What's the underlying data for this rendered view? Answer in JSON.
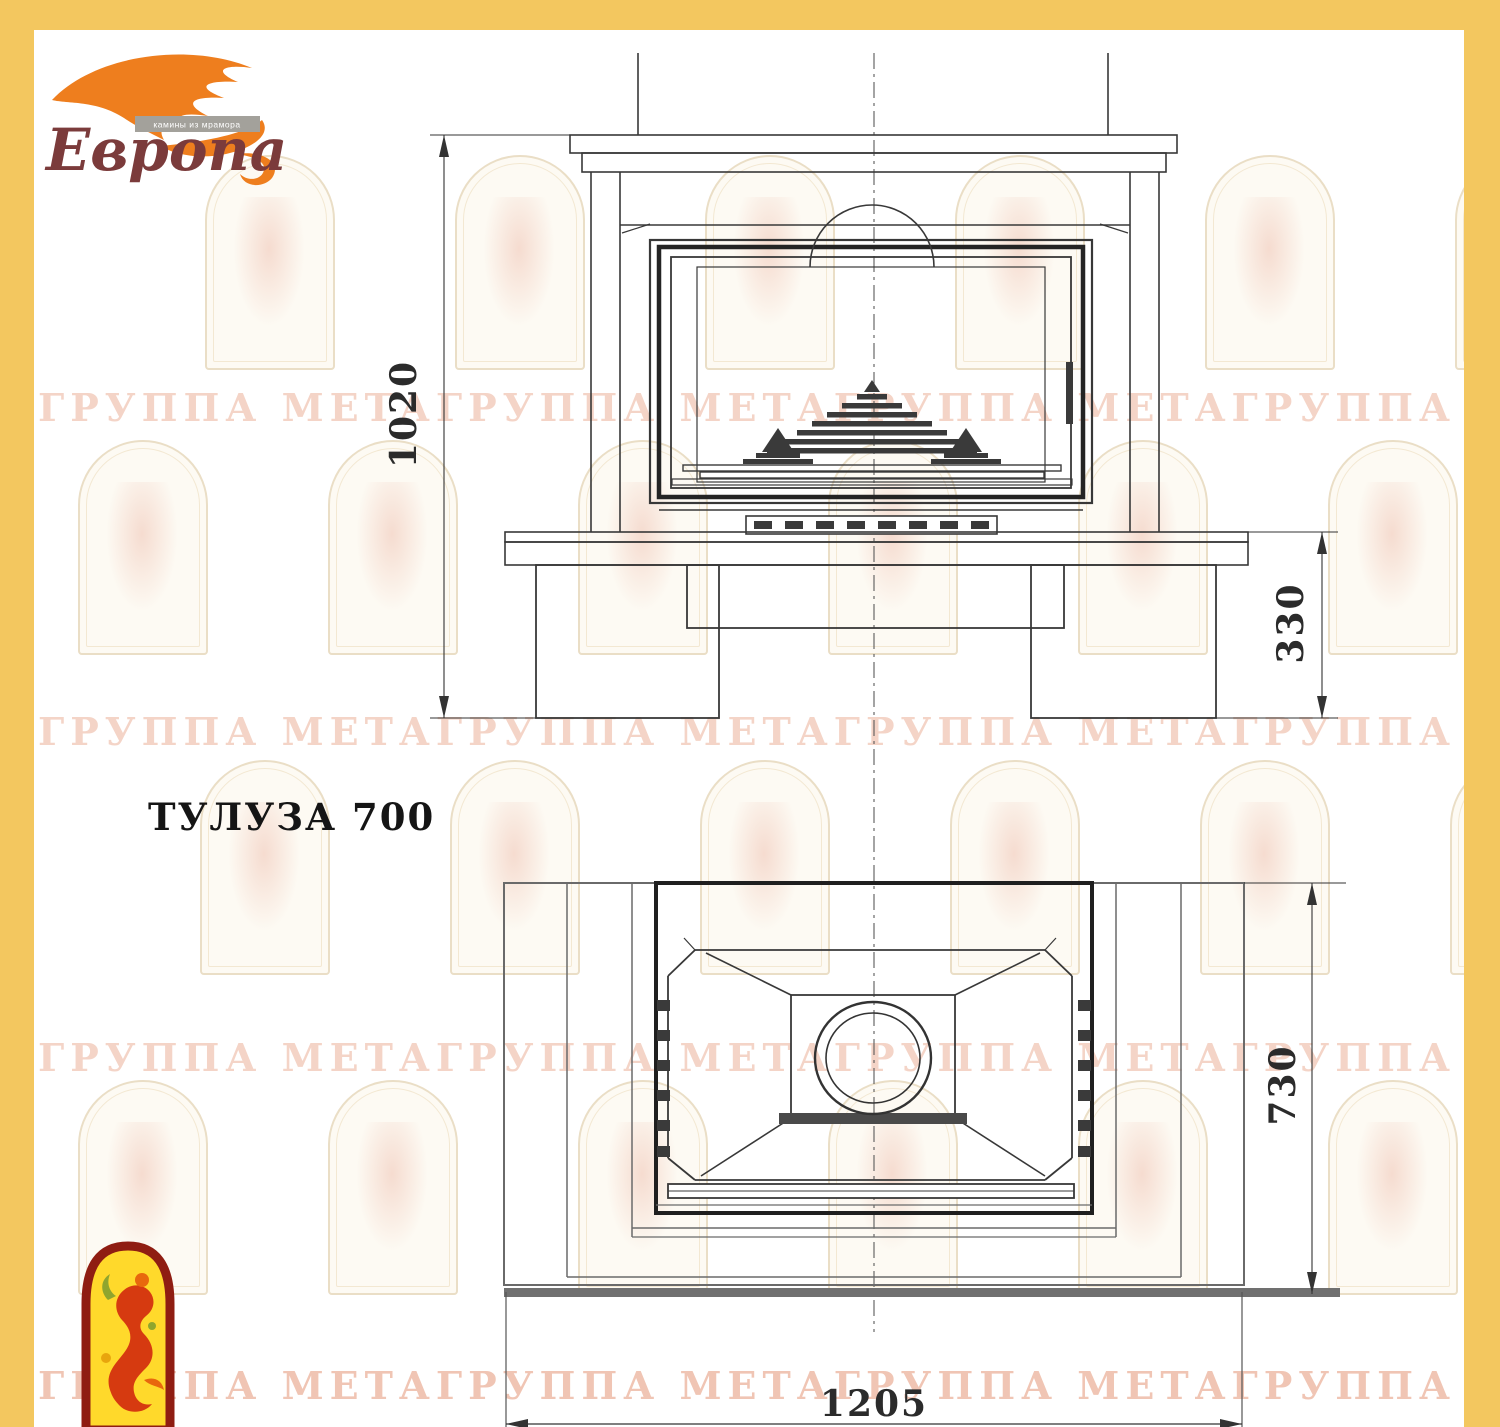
{
  "brand": {
    "name": "Европа",
    "tagline": "камины из мрамора"
  },
  "title": {
    "model": "ТУЛУЗА 700"
  },
  "dimensions": {
    "front_height": "1020",
    "base_height": "330",
    "plan_depth": "730",
    "plan_width": "1205"
  },
  "watermark": {
    "row_text": "ГРУППА МЕТАГРУППА МЕТАГРУППА МЕТАГРУППА МЕТА"
  },
  "colors": {
    "frame_yellow": "#F3C75F",
    "flame_orange": "#EE7E1E",
    "brand_maroon": "#7B3B3B",
    "emblem_red": "#8F1D12",
    "emblem_yellow": "#FFD92B",
    "line_dark": "#333333",
    "watermark_salmon": "#E09A7C"
  }
}
